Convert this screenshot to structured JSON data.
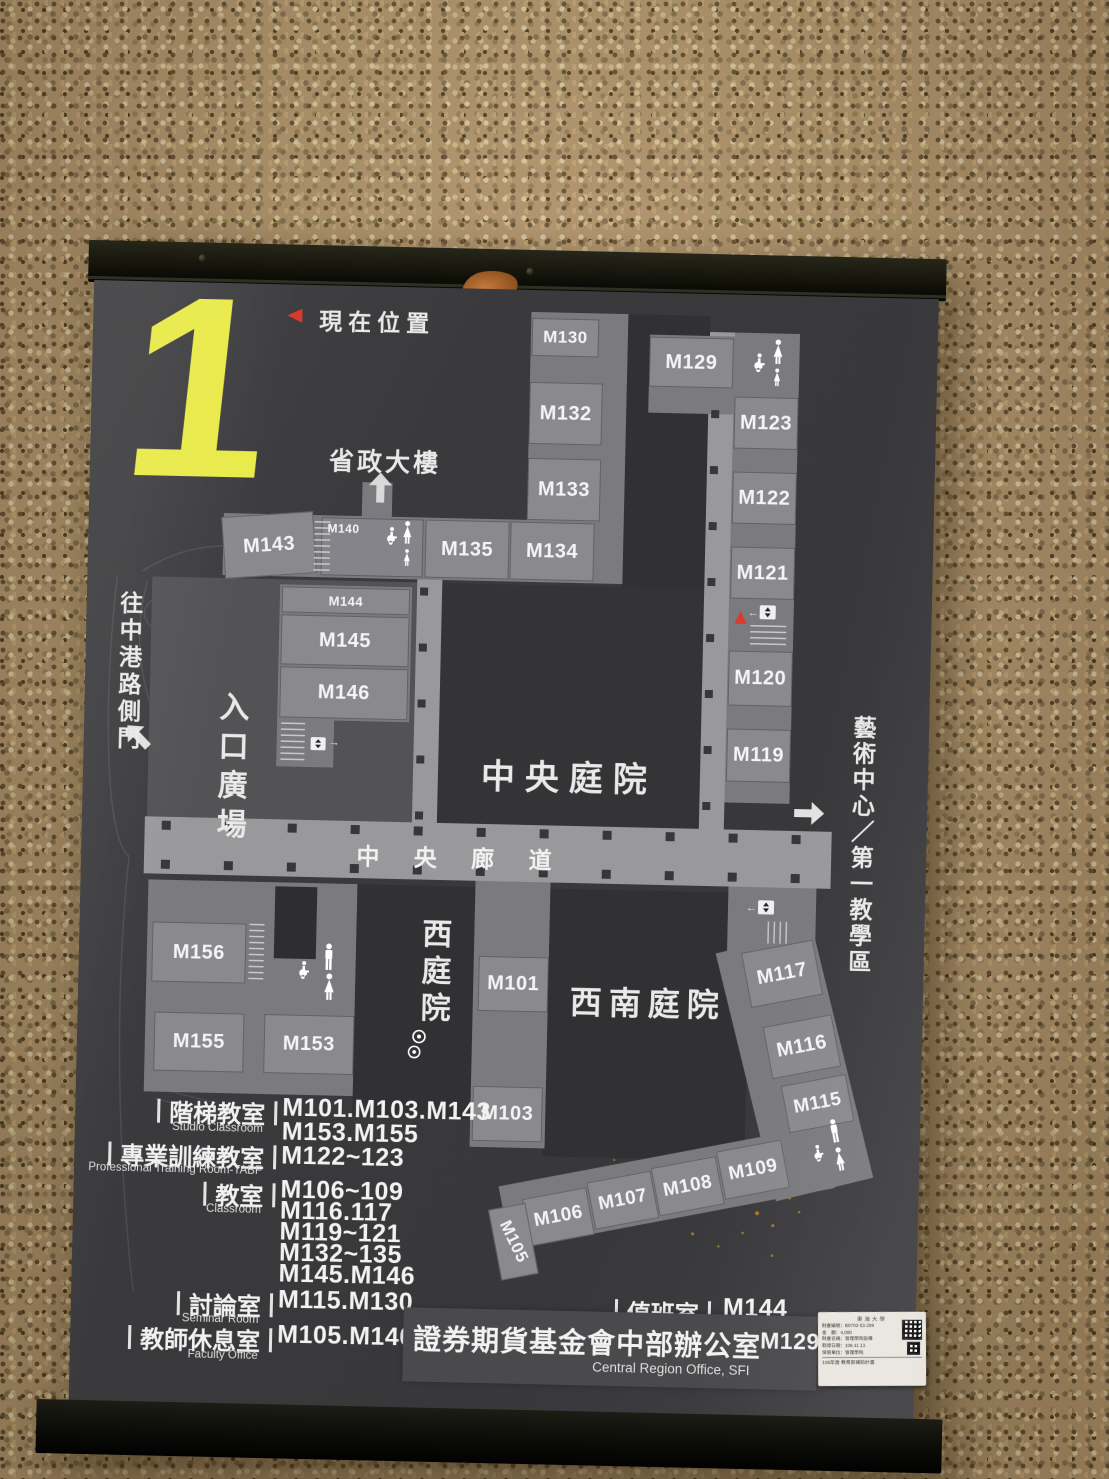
{
  "colors": {
    "accent_yellow": "#e9ea4a",
    "marker_red": "#d9392e",
    "board_bg": "#3a3a3c"
  },
  "floor": {
    "number": "1"
  },
  "current_location": {
    "label": "現在位置"
  },
  "map_labels": {
    "provincial_building": "省政大樓",
    "gate_side": "往中港路側門",
    "entrance_plaza": "入口廣場",
    "central_courtyard": "中央庭院",
    "central_corridor": "中 央 廊 道",
    "west_courtyard": "西庭院",
    "southwest_courtyard": "西南庭院",
    "art_center": "藝術中心／第一教學區"
  },
  "rooms": {
    "m101": "M101",
    "m103": "M103",
    "m105": "M105",
    "m106": "M106",
    "m107": "M107",
    "m108": "M108",
    "m109": "M109",
    "m115": "M115",
    "m116": "M116",
    "m117": "M117",
    "m119": "M119",
    "m120": "M120",
    "m121": "M121",
    "m122": "M122",
    "m123": "M123",
    "m129": "M129",
    "m130": "M130",
    "m132": "M132",
    "m133": "M133",
    "m134": "M134",
    "m135": "M135",
    "m140": "M140",
    "m143": "M143",
    "m144": "M144",
    "m145": "M145",
    "m146": "M146",
    "m153": "M153",
    "m155": "M155",
    "m156": "M156"
  },
  "legend": {
    "rows": [
      {
        "zh": "階梯教室",
        "en": "Studio Classroom",
        "values": [
          "M101.M103.M143",
          "M153.M155"
        ]
      },
      {
        "zh": "專業訓練教室",
        "en": "Professional Training Room-TABF",
        "values": [
          "M122~123"
        ]
      },
      {
        "zh": "教室",
        "en": "Classroom",
        "values": [
          "M106~109",
          "M116.117",
          "M119~121",
          "M132~135",
          "M145.M146"
        ]
      },
      {
        "zh": "討論室",
        "en": "Seminar Room",
        "values": [
          "M115.M130"
        ]
      },
      {
        "zh": "教師休息室",
        "en": "Faculty Office",
        "values": [
          "M105.M140"
        ]
      }
    ],
    "duty": {
      "zh": "值班室",
      "en": "Duty Room",
      "value": "M144"
    },
    "office": {
      "zh": "證券期貨基金會中部辦公室",
      "en": "Central Region Office, SFI",
      "value": "M129"
    }
  },
  "sticker": {
    "title": "東海大學",
    "lines": [
      "財產編號：B0703-03-208",
      "金　額：4,000",
      "財產名稱：管理學院設備",
      "取得日期：106.11.13",
      "保管單位：管理學院"
    ],
    "footer": "106年度 教育部補助計畫"
  }
}
